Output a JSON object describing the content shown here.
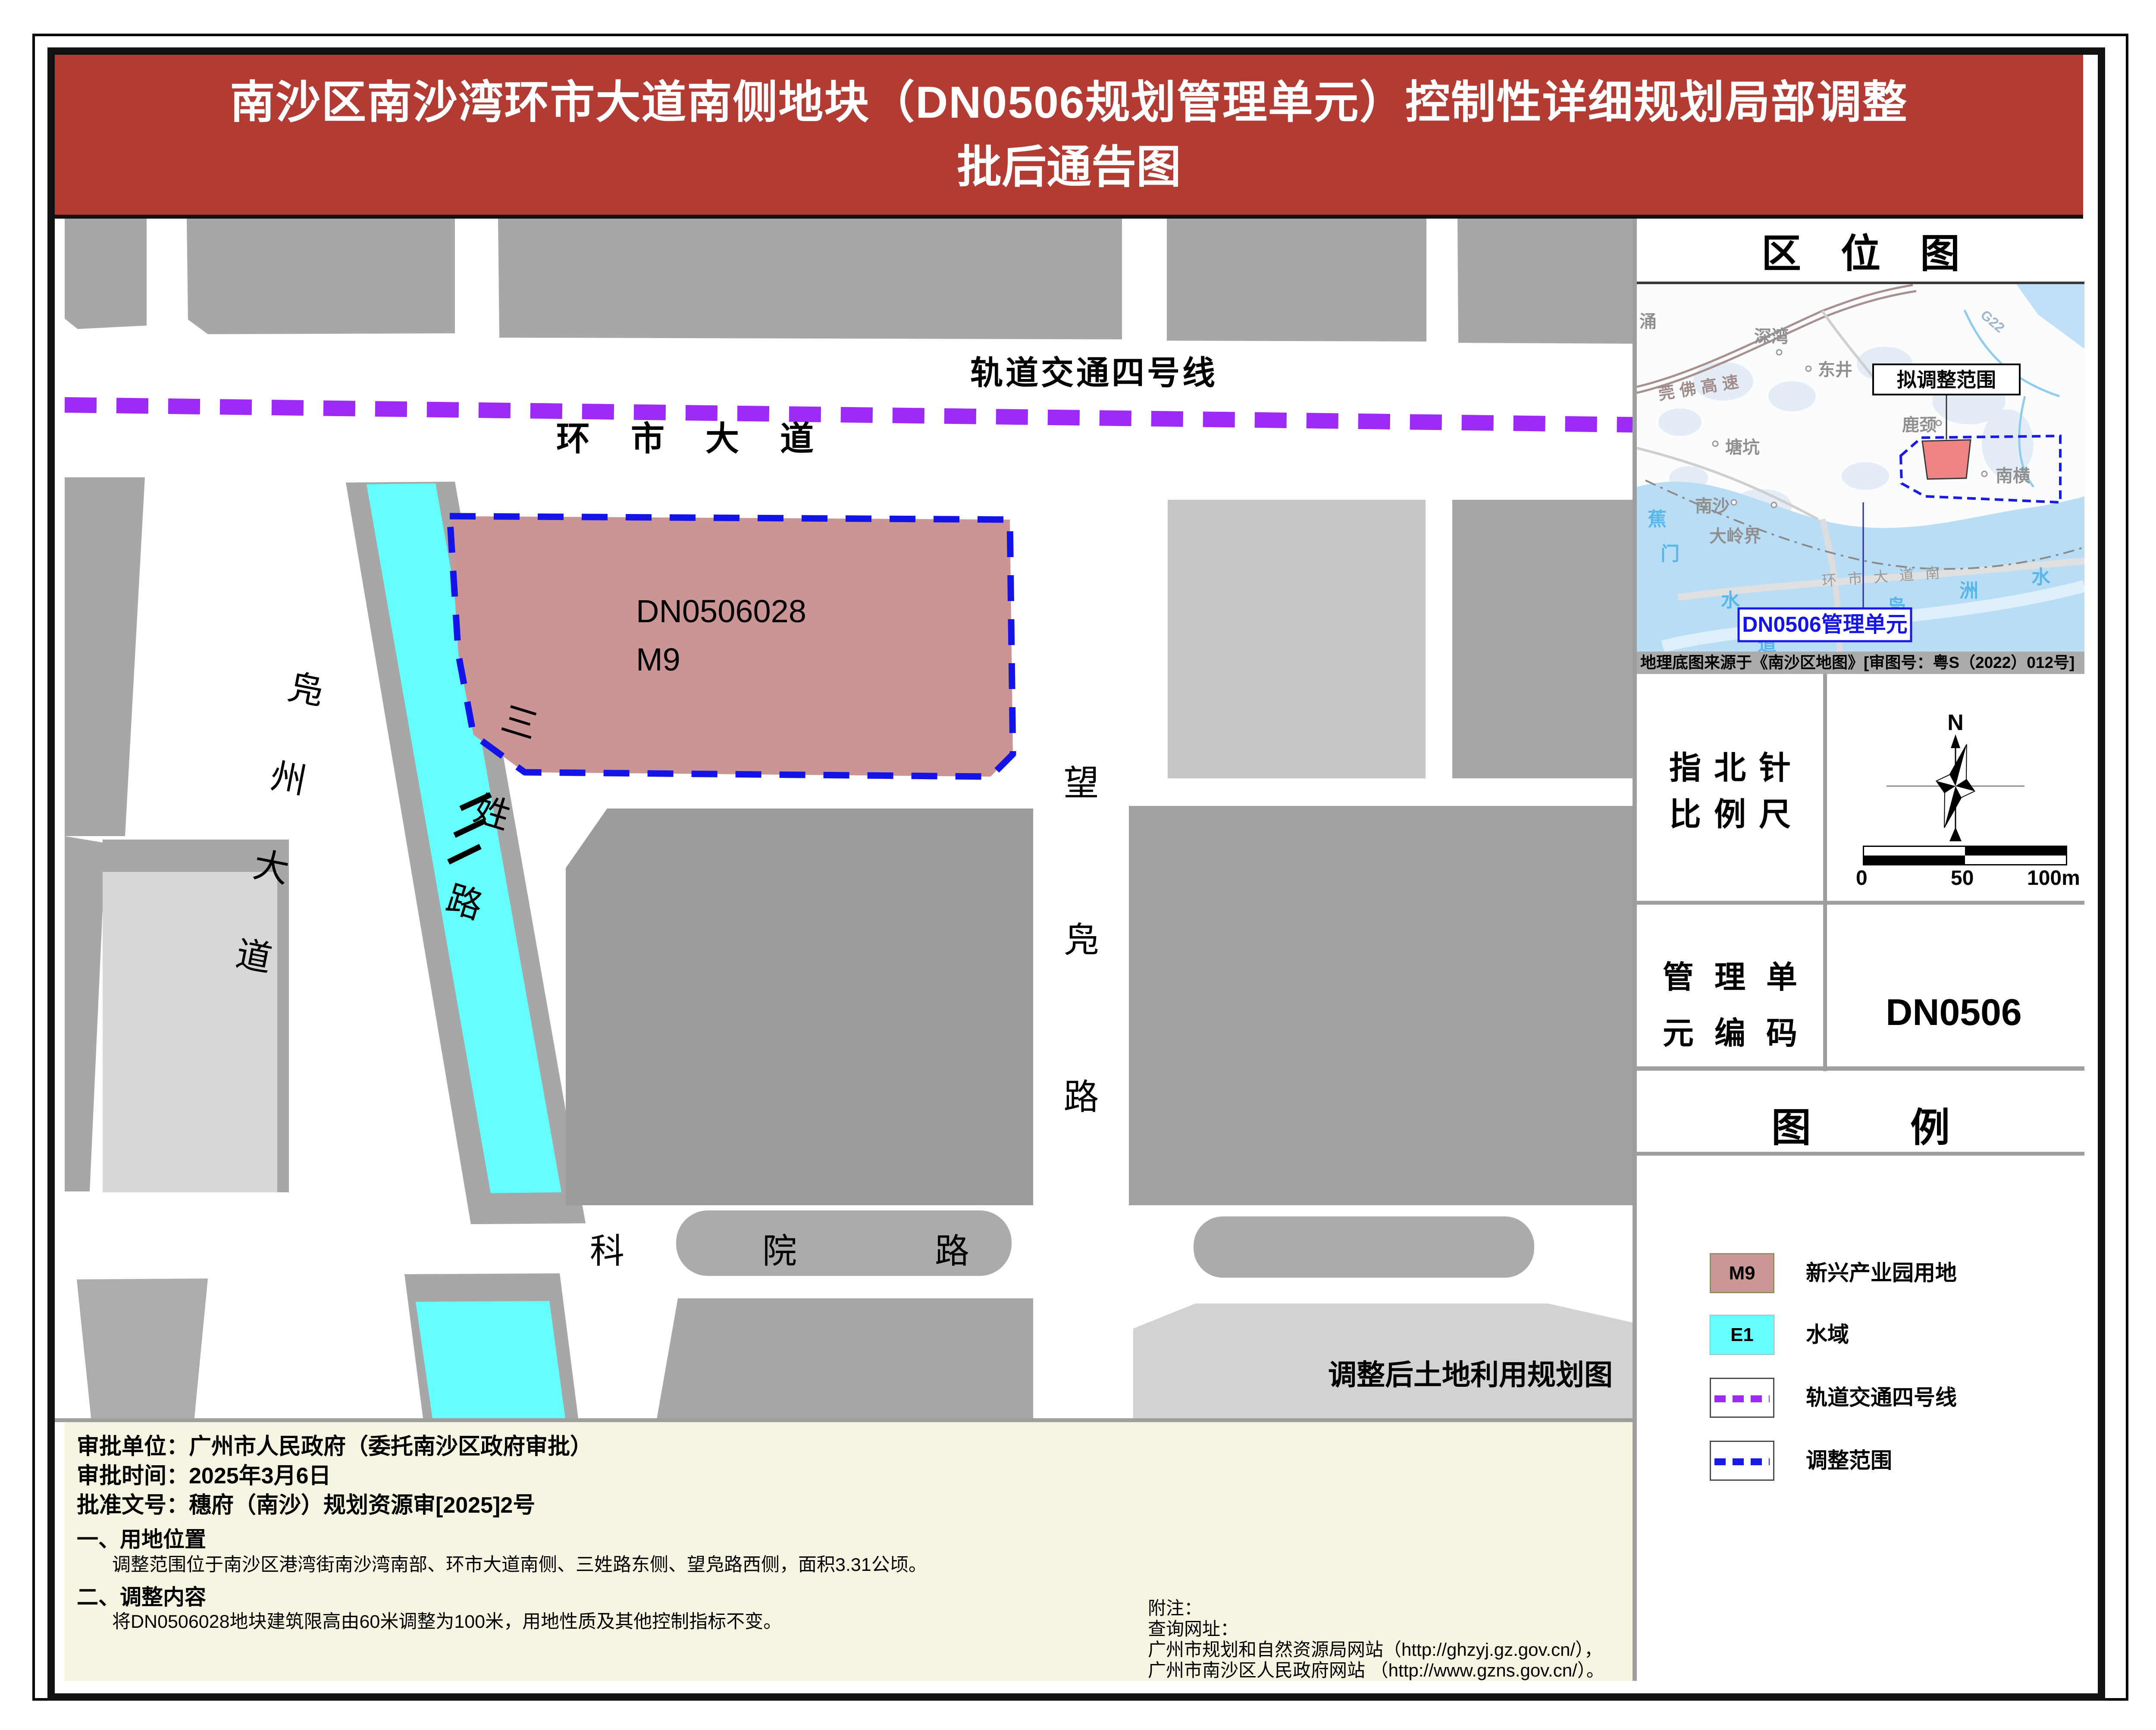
{
  "title": {
    "line1": "南沙区南沙湾环市大道南侧地块（DN0506规划管理单元）控制性详细规划局部调整",
    "line2": "批后通告图"
  },
  "map": {
    "metro_line_label": "轨道交通四号线",
    "road_huanshi": "环市大道",
    "parcel_code": "DN0506028",
    "parcel_use": "M9",
    "road_fuzhou": "凫州大道",
    "road_sanxing": "三姓路",
    "road_wangfu": "望凫路",
    "road_keyuan": "科院路",
    "caption": "调整后土地利用规划图",
    "colors": {
      "parcel_fill": "#CB9595",
      "water": "#66FFFF",
      "metro": "#9D2BF5",
      "boundary": "#1414E6"
    }
  },
  "locmap": {
    "title": "区位图",
    "callout": "拟调整范围",
    "unit_box": "DN0506管理单元",
    "caption": "地理底图来源于《南沙区地图》[审图号：粤S（2022）012号]",
    "highway": "莞佛高速",
    "g_road": "G22",
    "road_south": "环市大道南",
    "places": [
      "涌",
      "深湾",
      "东井",
      "塘坑",
      "鹿颈",
      "南横",
      "南沙",
      "大岭界"
    ],
    "water_chars": [
      "蕉",
      "门",
      "水",
      "道",
      "凫",
      "洲",
      "水"
    ]
  },
  "compass": {
    "title1": "指北针",
    "title2": "比例尺",
    "north": "N",
    "ticks": [
      "0",
      "50",
      "100m"
    ]
  },
  "unit": {
    "title1": "管理单",
    "title2": "元编码",
    "code": "DN0506"
  },
  "legend": {
    "title": "图例",
    "items": [
      {
        "code": "M9",
        "label": "新兴产业园用地",
        "color": "#CB9797"
      },
      {
        "code": "E1",
        "label": "水域",
        "color": "#66FFFF"
      },
      {
        "code": "",
        "label": "轨道交通四号线",
        "color": "#9D2BF5"
      },
      {
        "code": "",
        "label": "调整范围",
        "color": "#1A1AE6"
      }
    ]
  },
  "footer": {
    "line_unit": "审批单位：广州市人民政府（委托南沙区政府审批）",
    "line_date": "审批时间：2025年3月6日",
    "line_doc": "批准文号：穗府（南沙）规划资源审[2025]2号",
    "sec1": "一、用地位置",
    "sec1_body": "调整范围位于南沙区港湾街南沙湾南部、环市大道南侧、三姓路东侧、望凫路西侧，面积3.31公顷。",
    "sec2": "二、调整内容",
    "sec2_body": "将DN0506028地块建筑限高由60米调整为100米，用地性质及其他控制指标不变。",
    "notes": [
      "附注：",
      "查询网址：",
      "广州市规划和自然资源局网站（http://ghzyj.gz.gov.cn/），",
      "广州市南沙区人民政府网站 （http://www.gzns.gov.cn/）。"
    ]
  }
}
